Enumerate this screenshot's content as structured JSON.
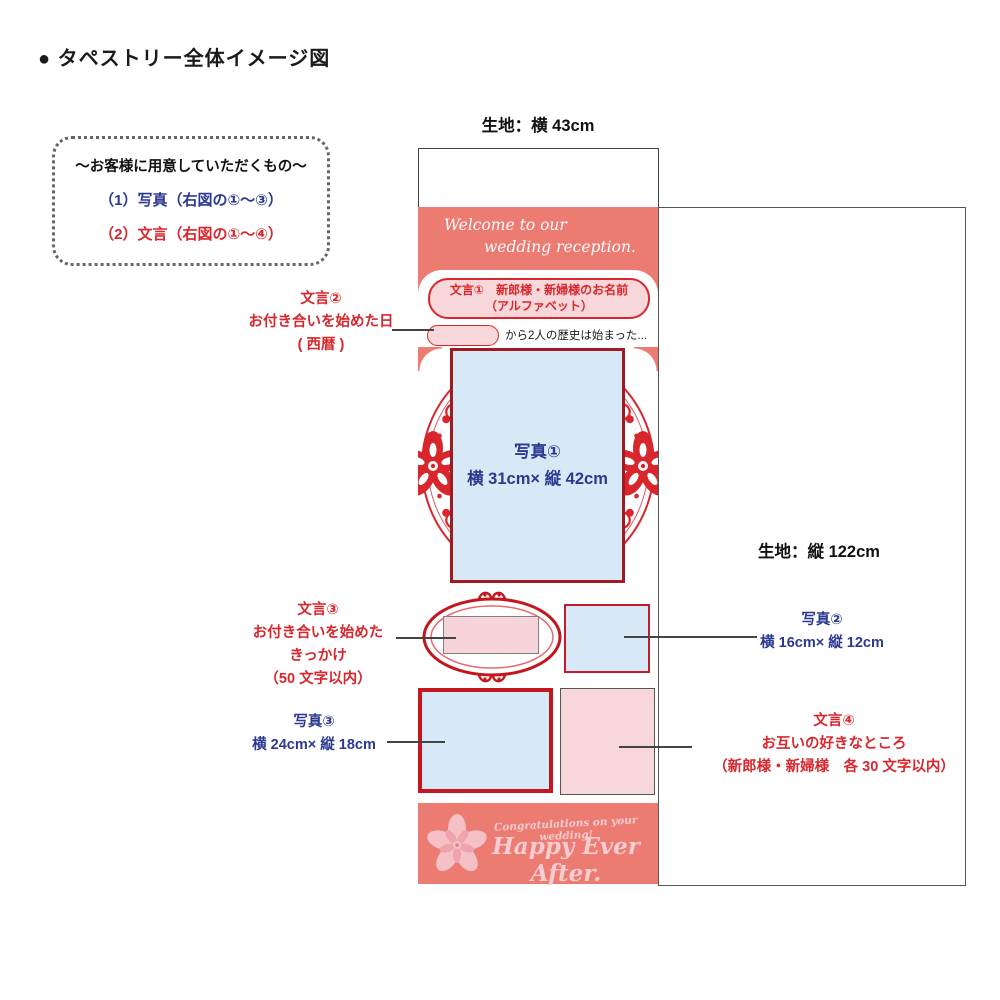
{
  "title": "● タペストリー全体イメージ図",
  "note_box": {
    "heading": "〜お客様に用意していただくもの〜",
    "item_photo": "（1）写真（右図の①〜③）",
    "item_text": "（2）文言（右図の①〜④）"
  },
  "fabric": {
    "width_label": "生地：横 43cm",
    "height_label": "生地：縦 122cm"
  },
  "tapestry": {
    "welcome_line1": "Welcome to our",
    "welcome_line2": "wedding reception.",
    "text1_line1": "文言①　新郎様・新婦様のお名前",
    "text1_line2": "（アルファベット）",
    "date_sentence": "から2人の歴史は始まった...",
    "photo1_title": "写真①",
    "photo1_size": "横 31cm× 縦 42cm",
    "footer_small": "Congratulations on your wedding!",
    "footer_large": "Happy Ever After."
  },
  "annotations": {
    "text2_title": "文言②",
    "text2_line1": "お付き合いを始めた日",
    "text2_line2": "( 西暦 )",
    "text3_title": "文言③",
    "text3_line1": "お付き合いを始めた",
    "text3_line2": "きっかけ",
    "text3_line3": "（50 文字以内）",
    "photo3_title": "写真③",
    "photo3_size": "横 24cm× 縦 18cm",
    "photo2_title": "写真②",
    "photo2_size": "横 16cm× 縦 12cm",
    "text4_title": "文言④",
    "text4_line1": "お互いの好きなところ",
    "text4_line2": "（新郎様・新婦様　各 30 文字以内）"
  },
  "colors": {
    "salmon": "#EC7B72",
    "accent_red": "#D9262C",
    "dark_red_border": "#9E1B22",
    "bright_red_border": "#C4161C",
    "navy_blue": "#2B3990",
    "light_blue": "#D7E8F7",
    "light_pink": "#F8D7DA",
    "footer_text_pink": "#F7CDD1"
  }
}
